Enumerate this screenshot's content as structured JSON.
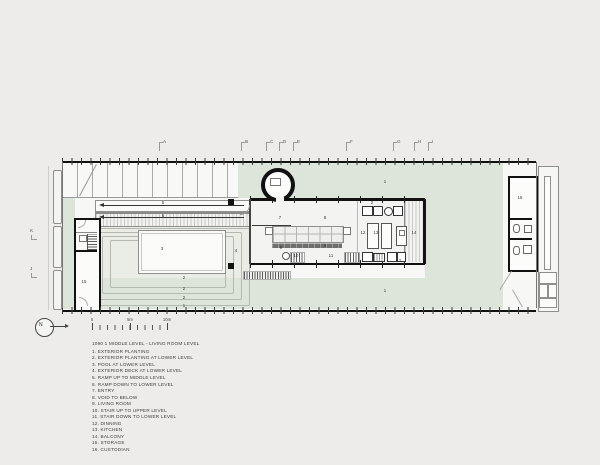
{
  "colors": {
    "paper": "#edecea",
    "plan_white": "#f7f7f5",
    "planting_green": "#dde4da",
    "terrace_tint": "#e9ede6",
    "wall_black": "#141414",
    "thin_line_gray": "#8f8f8f",
    "text_gray": "#3c3c3c"
  },
  "legend": {
    "title": "1090 1 MIDDLE LEVEL - LIVING ROOM LEVEL",
    "items": [
      {
        "n": "1",
        "text": "EXTERIOR PLANTING"
      },
      {
        "n": "2",
        "text": "EXTERIOR PLANTING AT LOWER LEVEL"
      },
      {
        "n": "3",
        "text": "POOL AT LOWER LEVEL"
      },
      {
        "n": "4",
        "text": "EXTERIOR DECK AT LOWER LEVEL"
      },
      {
        "n": "5",
        "text": "RAMP UP TO MIDDLE LEVEL"
      },
      {
        "n": "6",
        "text": "RAMP DOWN TO LOWER LEVEL"
      },
      {
        "n": "7",
        "text": "ENTRY"
      },
      {
        "n": "8",
        "text": "VOID TO BELOW"
      },
      {
        "n": "9",
        "text": "LIVING ROOM"
      },
      {
        "n": "10",
        "text": "STAIR UP TO UPPER LEVEL"
      },
      {
        "n": "11",
        "text": "STAIR DOWN TO LOWER LEVEL"
      },
      {
        "n": "12",
        "text": "DINNING"
      },
      {
        "n": "13",
        "text": "KITCHEN"
      },
      {
        "n": "14",
        "text": "BALCONY"
      },
      {
        "n": "15",
        "text": "STORAGE"
      },
      {
        "n": "16",
        "text": "CUSTODIAN"
      }
    ]
  },
  "north": {
    "label": "N"
  },
  "scale": {
    "ticks": [
      {
        "label": "0",
        "x": 92
      },
      {
        "label": "5m",
        "x": 130
      },
      {
        "label": "10m",
        "x": 167
      }
    ]
  },
  "plan": {
    "grid_top": [
      {
        "label": "A",
        "x": 163
      },
      {
        "label": "B",
        "x": 245
      },
      {
        "label": "C",
        "x": 270
      },
      {
        "label": "D",
        "x": 283
      },
      {
        "label": "E",
        "x": 297
      },
      {
        "label": "F",
        "x": 350
      },
      {
        "label": "G",
        "x": 397
      },
      {
        "label": "H",
        "x": 418
      },
      {
        "label": "I",
        "x": 432
      }
    ],
    "grid_left": [
      {
        "label": "K",
        "y": 229
      },
      {
        "label": "J",
        "y": 267
      }
    ],
    "labels": [
      {
        "t": "1",
        "x": 385,
        "y": 182
      },
      {
        "t": "1",
        "x": 385,
        "y": 291
      },
      {
        "t": "1",
        "x": 184,
        "y": 306
      },
      {
        "t": "2",
        "x": 184,
        "y": 278
      },
      {
        "t": "2",
        "x": 184,
        "y": 289
      },
      {
        "t": "2",
        "x": 184,
        "y": 298
      },
      {
        "t": "2",
        "x": 372,
        "y": 203
      },
      {
        "t": "2",
        "x": 400,
        "y": 261
      },
      {
        "t": "3",
        "x": 162,
        "y": 249
      },
      {
        "t": "4",
        "x": 236,
        "y": 251
      },
      {
        "t": "5",
        "x": 163,
        "y": 203
      },
      {
        "t": "6",
        "x": 163,
        "y": 216
      },
      {
        "t": "7",
        "x": 280,
        "y": 218
      },
      {
        "t": "8",
        "x": 325,
        "y": 218
      },
      {
        "t": "8",
        "x": 281,
        "y": 248
      },
      {
        "t": "9",
        "x": 325,
        "y": 246
      },
      {
        "t": "10",
        "x": 296,
        "y": 256
      },
      {
        "t": "11",
        "x": 331,
        "y": 256
      },
      {
        "t": "12",
        "x": 363,
        "y": 233
      },
      {
        "t": "13",
        "x": 376,
        "y": 233
      },
      {
        "t": "14",
        "x": 414,
        "y": 233
      },
      {
        "t": "15",
        "x": 84,
        "y": 282
      },
      {
        "t": "16",
        "x": 520,
        "y": 198
      }
    ]
  }
}
